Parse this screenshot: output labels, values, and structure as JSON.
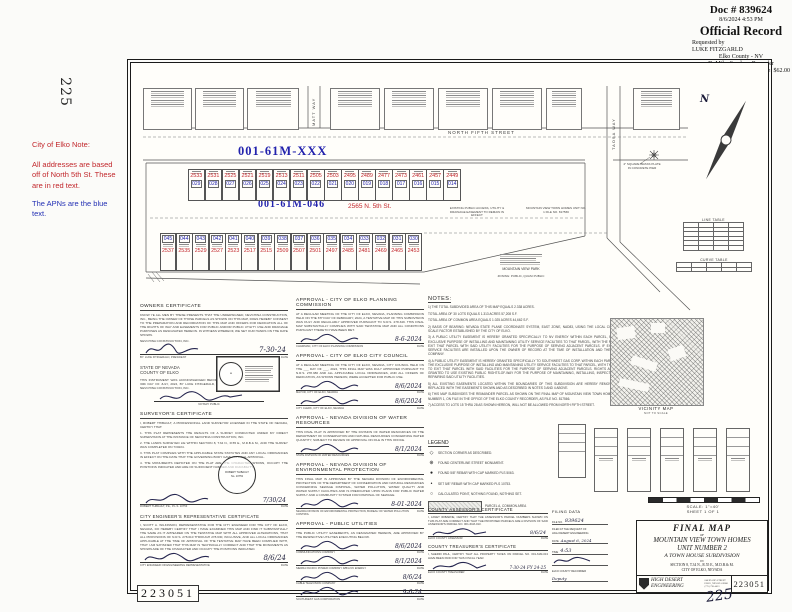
{
  "recorder": {
    "doc": "Doc # 839624",
    "datetime": "8/6/2024 4:53 PM",
    "title": "Official Record",
    "requested_by_label": "Requested by",
    "requested_by": "LUKE FITZGARLD",
    "county": "Elko County - NV",
    "recorder_name": "D. Mike Smales - Recorder",
    "page": "Pg 1 of 1",
    "fee": "Fee: $62.00",
    "recorded_by": "Recorded By: STUTTLE"
  },
  "margin": {
    "left_page_num": "225",
    "bottom_page_num": "225",
    "stamp_number": "223051",
    "note_title": "City of Elko Note:",
    "note_red": "All addresses are based off of North 5th St. These are in red text.",
    "note_blue": "The APNs are the blue text."
  },
  "labels": {
    "date": "DATE",
    "by": "BY:"
  },
  "map": {
    "north_label": "N",
    "street_north": "NORTH FIFTH STREET",
    "street_matt": "MATT WAY",
    "street_taosa": "TAOSA WAY",
    "apn_new": "001-61M-XXX",
    "apn_parcel": "001-61M-046",
    "address_parcel": "2565 N. 5th St.",
    "parcel_a": "PARCEL A",
    "common_area": "COMMON AREA",
    "row1_addresses": [
      "2533",
      "2531",
      "2525",
      "2521",
      "2519",
      "2513",
      "2511",
      "2505",
      "2503",
      "2495",
      "2489",
      "2477",
      "2473",
      "2461",
      "2457",
      "2449"
    ],
    "row1_apns": [
      "029",
      "028",
      "027",
      "026",
      "025",
      "024",
      "023",
      "022",
      "021",
      "020",
      "019",
      "018",
      "017",
      "016",
      "015",
      "014"
    ],
    "row2_apns": [
      "045",
      "044",
      "043",
      "042",
      "041",
      "040",
      "039",
      "038",
      "037",
      "036",
      "035",
      "034",
      "033",
      "032",
      "031",
      "030"
    ],
    "row2_addresses": [
      "2537",
      "2535",
      "2529",
      "2527",
      "2523",
      "2517",
      "2515",
      "2509",
      "2507",
      "2501",
      "2497",
      "2485",
      "2481",
      "2469",
      "2465",
      "2453"
    ],
    "easement_label": "EXISTING PUBLIC ACCESS, UTILITY & DRAINAGE EASEMENT TO REMAIN IN EFFECT",
    "unit1_label": "MOUNTAIN VIEW TOWN HOMES UNIT NO. 1 FILE NO. 817566",
    "park_label": "MOUNTAIN VIEW PARK",
    "park_zoning": "ZONING: PUBLIC, QUASI PUBLIC",
    "monument_label": "4\" SQUARE BRASS PLATE IN CONCRETE PIER",
    "line_table_title": "LINE TABLE",
    "curve_table_title": "CURVE TABLE"
  },
  "notes": {
    "title": "NOTES:",
    "items": [
      "1) THE TOTAL SUBDIVIDED AREA OF THIS MAP EQUALS 2.338 ACRES.",
      "TOTAL AREA OF 30 LOTS EQUALS 1.313 ACRES      57,208 S.F.",
      "TOTAL AREA OF COMMON AREA EQUALS 1.025 ACRES      44,662 S.F.",
      "2) BASIS OF BEARING: NEVADA STATE PLANE COORDINATE SYSTEM, EAST ZONE, NAD83, USING THE LOCAL COMBINED SCALE FACTOR ESTABLISHED BY THE CITY OF ELKO.",
      "3) A PUBLIC UTILITY EASEMENT IS HEREBY GRANTED SPECIFICALLY TO NV ENERGY WITHIN EACH PARCEL, FOR THE EXCLUSIVE PURPOSE OF INSTALLING AND MAINTAINING UTILITY SERVICE FACILITIES TO THAT PARCEL, WITH THE RIGHT TO EXIT THAT PARCEL WITH SAID UTILITY FACILITIES FOR THE PURPOSE OF SERVING ADJACENT PARCELS. IF EXECUTED SERVICE FACILITIES ARE INSTALLED UPON THE OWNER OF RECORD AT THE TIME OF INSTALLATION AND THE UTILITY COMPANY.",
      "4) A PUBLIC UTILITY EASEMENT IS HEREBY GRANTED SPECIFICALLY TO SOUTHWEST GAS CORP. WITHIN EACH PARCEL FOR THE EXCLUSIVE PURPOSE OF INSTALLING AND MAINTAINING UTILITY SERVICE FACILITIES TO THAT PARCEL, WITH THE RIGHT TO EXIT THAT PARCEL WITH SAID FACILITIES FOR THE PURPOSE OF SERVING ADJACENT PARCELS. RIGHTS ARE ALSO GRANTED TO USE EXISTING PUBLIC RIGHTS-OF-WAY FOR THE PURPOSE OF MAINTAINING, INSTALLING, INSPECTING AND REPAIRING SAID UTILITY FACILITIES.",
      "5) ALL EXISTING EASEMENTS LOCATED WITHIN THE BOUNDARIES OF THIS SUBDIVISION ARE HEREBY REMOVED AND REPLACED WITH THE EASEMENTS SHOWN AND AS DESCRIBED IN NOTES 3 AND 4 ABOVE.",
      "6) THIS MAP SUBDIVIDES THE REMAINDER PARCEL AS SHOWN ON THE FINAL MAP OF MOUNTAIN VIEW TOWN HOMES, UNIT NUMBER 1, ON FILE IN THE OFFICE OF THE ELKO COUNTY RECORDER, AS FILE NO. 817566.",
      "7) ACCESS TO LOTS 15 THRU 28 AS SHOWN HEREON, WILL NOT BE ALLOWED FROM NORTH FIFTH STREET."
    ]
  },
  "legend": {
    "title": "LEGEND",
    "items": [
      {
        "sym": "◇",
        "text": "SECTION CORNER AS DESCRIBED."
      },
      {
        "sym": "⊕",
        "text": "FOUND CENTERLINE STREET MONUMENT."
      },
      {
        "sym": "●",
        "text": "FOUND 5/8\" REBAR WITH CAP MARKED PLS 5063."
      },
      {
        "sym": "•",
        "text": "SET 5/8\" REBAR WITH CAP MARKED PLS 10753."
      },
      {
        "sym": "○",
        "text": "CALCULATED POINT, NOTHING FOUND, NOTHING SET."
      }
    ],
    "swatch_label": "PARCEL A, COMMON AREA"
  },
  "vicinity": {
    "title": "VICINITY MAP",
    "subtitle": "NOT TO SCALE"
  },
  "certs": {
    "owners": {
      "title": "OWNERS CERTIFICATE",
      "body": "KNOW YE ALL MEN BY THESE PRESENTS THAT THE UNDERSIGNED, NEVCHINA CONSTRUCTION, INC., BEING THE OWNER OF THOSE PARCELS AS SHOWN ON THIS MAP, DOES HEREBY CONSENT TO THE PREPARATION AND RECORDATION OF THIS MAP AND OFFERS FOR DEDICATION ALL OF THE RIGHTS OF WAY AND EASEMENTS FOR PUBLIC AND/OR PUBLIC UTILITY USE AND DRAINAGE PURPOSES AS DESIGNATED HEREON. IN WITNESS WHEREOF, WE SET OUR HANDS ON THE DATE SHOWN.",
      "company": "NEVCHINA CONSTRUCTION, INC.",
      "by_line": "BY: LUKE FITZGERALD, PRESIDENT",
      "date": "7-30-24",
      "state": "STATE OF NEVADA",
      "county": "COUNTY OF ELKO",
      "ack": "THIS INSTRUMENT WAS ACKNOWLEDGED BEFORE ME ON THE 30th DAY OF JULY, 2024, BY LUKE FITZGERALD, PRESIDENT OF NEVCHINA CONSTRUCTION, INC.",
      "notary_label": "NOTARY PUBLIC"
    },
    "surveyor": {
      "title": "SURVEYOR'S CERTIFICATE",
      "intro": "I, ROBERT THIBAULT, A PROFESSIONAL LAND SURVEYOR LICENSED IN THE STATE OF NEVADA, CERTIFY THAT:",
      "items": [
        "1.  THIS PLAT REPRESENTS THE RESULTS OF A SURVEY CONDUCTED UNDER MY DIRECT SUPERVISION AT THE INSTANCE OF NEVCHINA CONSTRUCTION, INC.",
        "2.  THE LANDS SURVEYED LIE WITHIN SECTION 8, T.34 N., R.55 E., M.D.B.& M., AND THE SURVEY WAS COMPLETED ON 7/30/24.",
        "3.  THIS PLAT COMPLIES WITH THE APPLICABLE STATE STATUTES AND ANY LOCAL ORDINANCES IN EFFECT ON THE DATE THAT THE GOVERNING BODY GAVE ITS FINAL APPROVAL.",
        "4.  THE MONUMENTS DEPICTED ON THE PLAT ARE THE CHARACTER SHOWN, OCCUPY THE POSITIONS INDICATED AND ARE OF SUFFICIENT NUMBER AND DURABILITY."
      ],
      "name_line": "ROBERT THIBAULT, P.E., P.L.S. 10753",
      "date": "7/30/24",
      "seal_name": "ROBERT THIBAULT",
      "seal_no": "No. 10753"
    },
    "engineer": {
      "title": "CITY ENGINEER'S REPRESENTATIVE CERTIFICATE",
      "body": "I, SCOTT A. WILKINSON, REPRESENTATIVE FOR THE CITY ENGINEER FOR THE CITY OF ELKO, NEVADA, DO HEREBY CERTIFY THAT I HAVE EXAMINED THIS MAP AND FIND IT SUBSTANTIALLY THE SAME AS IT APPEARED ON THE TENTATIVE MAP WITH ALL APPROVED ALTERATIONS, THAT ALL PROVISIONS OF N.R.S. 278.010 THROUGH 278.630, INCLUSIVE, AND ALL LOCAL ORDINANCES APPLICABLE AT THE TIME OF APPROVAL OF THE TENTATIVE MAP HAVE BEEN COMPLIED WITH, THAT I AM SATISFIED THAT THIS MAP IS TECHNICALLY CORRECT AND THAT THE MONUMENTS AS SHOWN ARE OF THE CHARACTER AND OCCUPY THE POSITIONS INDICATED.",
      "sig_label": "CITY ENGINEER OR ENGINEERING REPRESENTATIVE",
      "date": "8/6/24"
    },
    "approvals": [
      {
        "title": "APPROVAL - CITY OF ELKO PLANNING COMMISSION",
        "body": "AT A REGULAR MEETING OF THE CITY OF ELKO, NEVADA, PLANNING COMMISSION HELD ON THE 6TH DAY OF FEBRUARY, 2024, A TENTATIVE MAP OF THIS SUBDIVISION WAS DULY AND REGULARLY APPROVED PURSUANT TO N.R.S. 278.349. THIS FINAL MAP SUBSTANTIALLY COMPLIES WITH SAID TENTATIVE MAP AND ALL CONDITIONS PURSUANT THERETO HAVE BEEN MET.",
        "sigs": [
          {
            "label": "CHAIRMAN, CITY OF ELKO PLANNING COMMISSION",
            "date": "8-6-2024"
          }
        ]
      },
      {
        "title": "APPROVAL - CITY OF ELKO CITY COUNCIL",
        "body": "AT A REGULAR MEETING OF THE CITY OF ELKO, NEVADA, CITY COUNCIL HELD ON THE ___ DAY OF ___, 2024, THIS FINAL MAP WAS DULY APPROVED PURSUANT TO N.R.S. 278.380 AND ALL APPLICABLE LOCAL ORDINANCES, AND ALL OFFERS OF DEDICATION, AS SHOWN HEREON, WERE ACCEPTED FOR PUBLIC USE.",
        "sigs": [
          {
            "label": "MAYOR, CITY OF ELKO, NEVADA",
            "date": "8/6/2024"
          },
          {
            "label": "CITY CLERK, CITY OF ELKO, NEVADA",
            "date": "8/6/2024"
          }
        ]
      },
      {
        "title": "APPROVAL - NEVADA DIVISION OF WATER RESOURCES",
        "body": "THIS FINAL PLAT IS APPROVED BY THE DIVISION OF WATER RESOURCES OF THE DEPARTMENT OF CONSERVATION AND NATURAL RESOURCES CONCERNING WATER QUANTITY, SUBJECT TO REVIEW OF APPROVAL ON FILE IN THIS OFFICE.",
        "sigs": [
          {
            "label": "STATE DIVISION OF WATER RESOURCES",
            "date": "8/1/2024"
          }
        ]
      },
      {
        "title": "APPROVAL - NEVADA DIVISION OF ENVIRONMENTAL PROTECTION",
        "body": "THIS FINAL MAP IS APPROVED BY THE NEVADA DIVISION OF ENVIRONMENTAL PROTECTION OF THE DEPARTMENT OF CONSERVATION AND NATURAL RESOURCES CONCERNING SEWAGE DISPOSAL, WATER POLLUTION, WATER QUALITY AND WATER SUPPLY FACILITIES AND IS PREDICATED UPON PLANS FOR PUBLIC WATER SUPPLY AND A COMMUNITY SYSTEM FOR DISPOSAL OF SEWAGE.",
        "sigs": [
          {
            "label": "NEVADA DIVISION OF ENVIRONMENTAL PROTECTION, BUREAU OF WATER POLLUTION CONTROL",
            "date": "8-01-2024"
          }
        ]
      },
      {
        "title": "APPROVAL - PUBLIC UTILITIES",
        "body": "THE PUBLIC UTILITY EASEMENTS, AS DESIGNATED HEREON, ARE APPROVED BY THE RESPECTIVE UTILITIES EXECUTING BELOW.",
        "sigs": [
          {
            "label": "COMMUNICATIONS COMPANY",
            "date": "8/6/2024"
          },
          {
            "label": "SIERRA PACIFIC POWER COMPANY D/B/A NV ENERGY",
            "date": "8/1/2024"
          },
          {
            "label": "CABLE TELEVISION COMPANY",
            "date": "8/6/24"
          },
          {
            "label": "SOUTHWEST GAS CORPORATION",
            "date": "9-6-24"
          }
        ]
      }
    ],
    "assessor": {
      "title": "COUNTY ASSESSOR'S CERTIFICATE",
      "body": "I, JANET IRIBARNE, CERTIFY THAT THE ASSESSOR'S PARCEL NUMBERS SHOWN ON THIS PLAT ARE CORRECT AND THAT THE PROPOSED PARCELS ARE A DIVISION OF SAID ASSESSOR'S PARCEL NO. 001-61M-013.",
      "sig_label": "ELKO COUNTY ASSESSOR",
      "date": "8/6/24"
    },
    "treasurer": {
      "title": "COUNTY TREASURER'S CERTIFICATE",
      "body": "I, SHERRI PAUL, CERTIFY THAT ALL PROPERTY TAXES ON PARCEL NO. 001-61M-013 HAVE BEEN PAID FOR THIS FISCAL YEAR.",
      "sig_label": "ELKO COUNTY TREASURER",
      "date": "7-30-24 FY 24-25"
    }
  },
  "filing": {
    "title": "FILING DATA",
    "file_no_label": "FILE NO.",
    "file_no": "839624",
    "request_label": "FILED AT THE REQUEST OF",
    "request": "HIGH DESERT ENGINEERING",
    "date_label": "DATE",
    "date": "August 6, 2024",
    "time_label": "TIME",
    "time": "4:53",
    "recorder_label": "ELKO COUNTY RECORDER",
    "deputy": "Deputy"
  },
  "titleblock": {
    "scale": "SCALE: 1\"=40'",
    "sheet": "SHEET 1 OF 1",
    "final_map": "FINAL MAP",
    "of": "OF",
    "name1": "MOUNTAIN VIEW TOWN HOMES",
    "name2": "UNIT NUMBER 2",
    "subtitle": "A TOWN HOUSE SUBDIVISION",
    "in_word": "IN",
    "section": "SECTION 8, T.34 N., R.55 E., M.D.B.& M.",
    "city": "CITY OF ELKO, NEVADA",
    "firm1": "HIGH DESERT",
    "firm2": "ENGINEERING",
    "firm_addr": "640 IDAHO STREET ELKO, NEVADA 89801 (775) 738-4053",
    "number": "223051"
  }
}
